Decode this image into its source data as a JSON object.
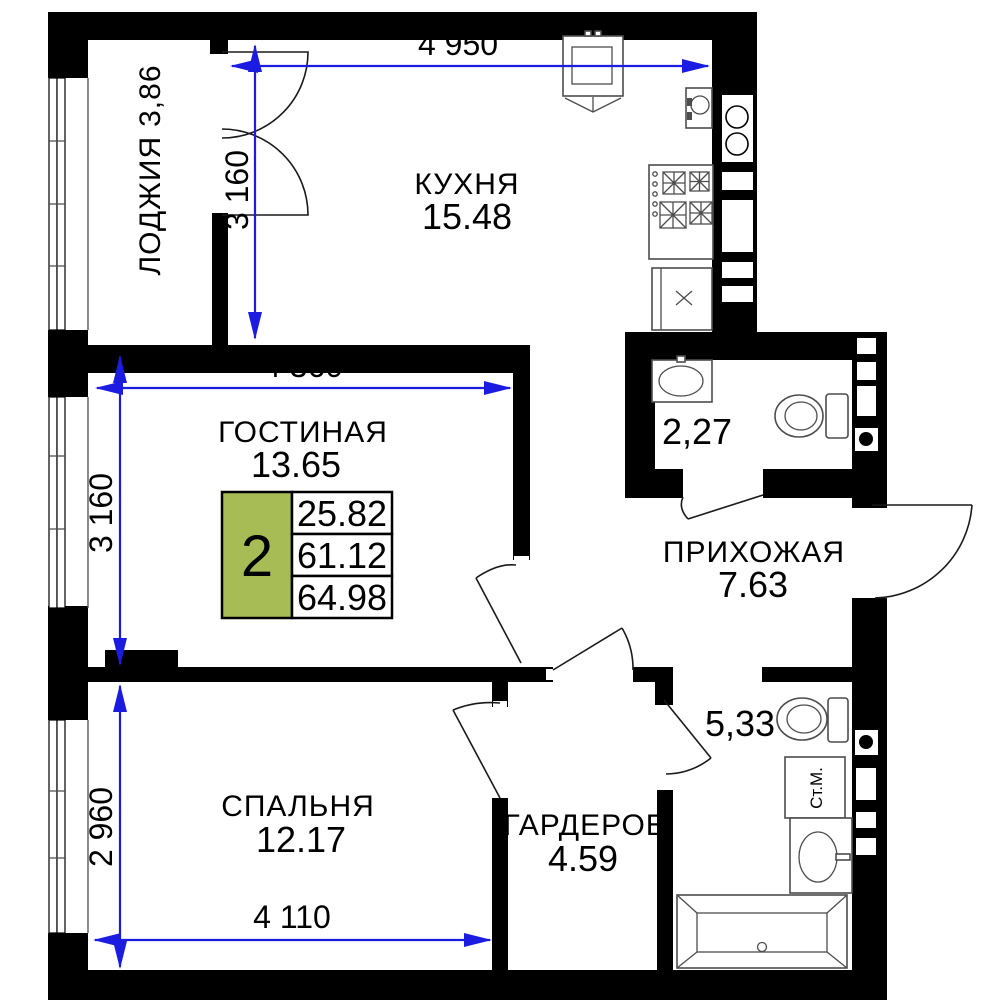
{
  "plan_title": "2-room apartment floor plan",
  "colors": {
    "wall": "#000000",
    "dimension_blue": "#1c1ce0",
    "accent_green": "#a8bc55",
    "fixture_gray": "#4d4d4d"
  },
  "rooms": {
    "kitchen": {
      "name": "КУХНЯ",
      "area": "15.48"
    },
    "loggia": {
      "name": "ЛОДЖИЯ",
      "area": "3,86"
    },
    "living": {
      "name": "ГОСТИНАЯ",
      "area": "13.65"
    },
    "hallway": {
      "name": "ПРИХОЖАЯ",
      "area": "7.63"
    },
    "bedroom": {
      "name": "СПАЛЬНЯ",
      "area": "12.17"
    },
    "wardrobe": {
      "name": "ГАРДЕРОБ",
      "area": "4.59"
    },
    "bathroom_small": {
      "area": "2,27"
    },
    "bathroom_large": {
      "area": "5,33"
    }
  },
  "dimensions": {
    "kitchen_width": "4 950",
    "kitchen_height": "3 160",
    "living_width": "4 360",
    "living_height": "3 160",
    "bedroom_height": "2 960",
    "bedroom_width": "4 110"
  },
  "summary": {
    "rooms_count": "2",
    "living_area": "25.82",
    "area_no_balcony": "61.12",
    "total_area": "64.98"
  },
  "labels": {
    "washing_machine": "Ст.М."
  }
}
